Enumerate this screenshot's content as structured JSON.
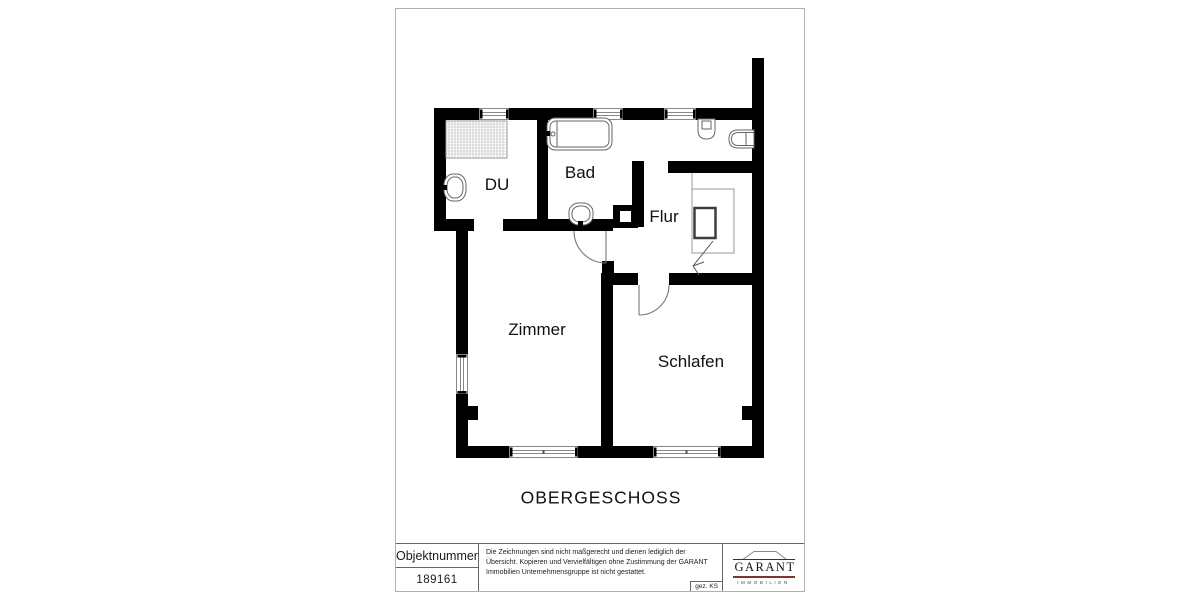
{
  "plan": {
    "floor_title": "OBERGESCHOSS",
    "rooms": {
      "du": "DU",
      "bad": "Bad",
      "flur": "Flur",
      "zimmer": "Zimmer",
      "schlafen": "Schlafen"
    },
    "fixtures": {
      "shower": "shower-tray",
      "du_sink": "washbasin",
      "bathtub": "bathtub",
      "bad_sink": "washbasin",
      "toilet": "toilet",
      "hand_basin": "hand-basin",
      "stairs": "staircase-down-arrow",
      "shaft": "chimney-shaft"
    }
  },
  "title_block": {
    "object_number_label": "Objektnummer",
    "object_number": "189161",
    "disclaimer": "Die Zeichnungen sind nicht maßgerecht und dienen lediglich der Übersicht. Kopieren und Vervielfältigen ohne Zustimmung der GARANT Immobilien Unternehmensgruppe ist nicht gestattet.",
    "signed": "gez. KS",
    "logo": {
      "brand": "GARANT",
      "division": "IMMOBILIEN"
    }
  },
  "colors": {
    "wall": "#000000",
    "thin_line": "#808080",
    "logo_accent": "#7d3434",
    "text": "#1a1a1a"
  }
}
